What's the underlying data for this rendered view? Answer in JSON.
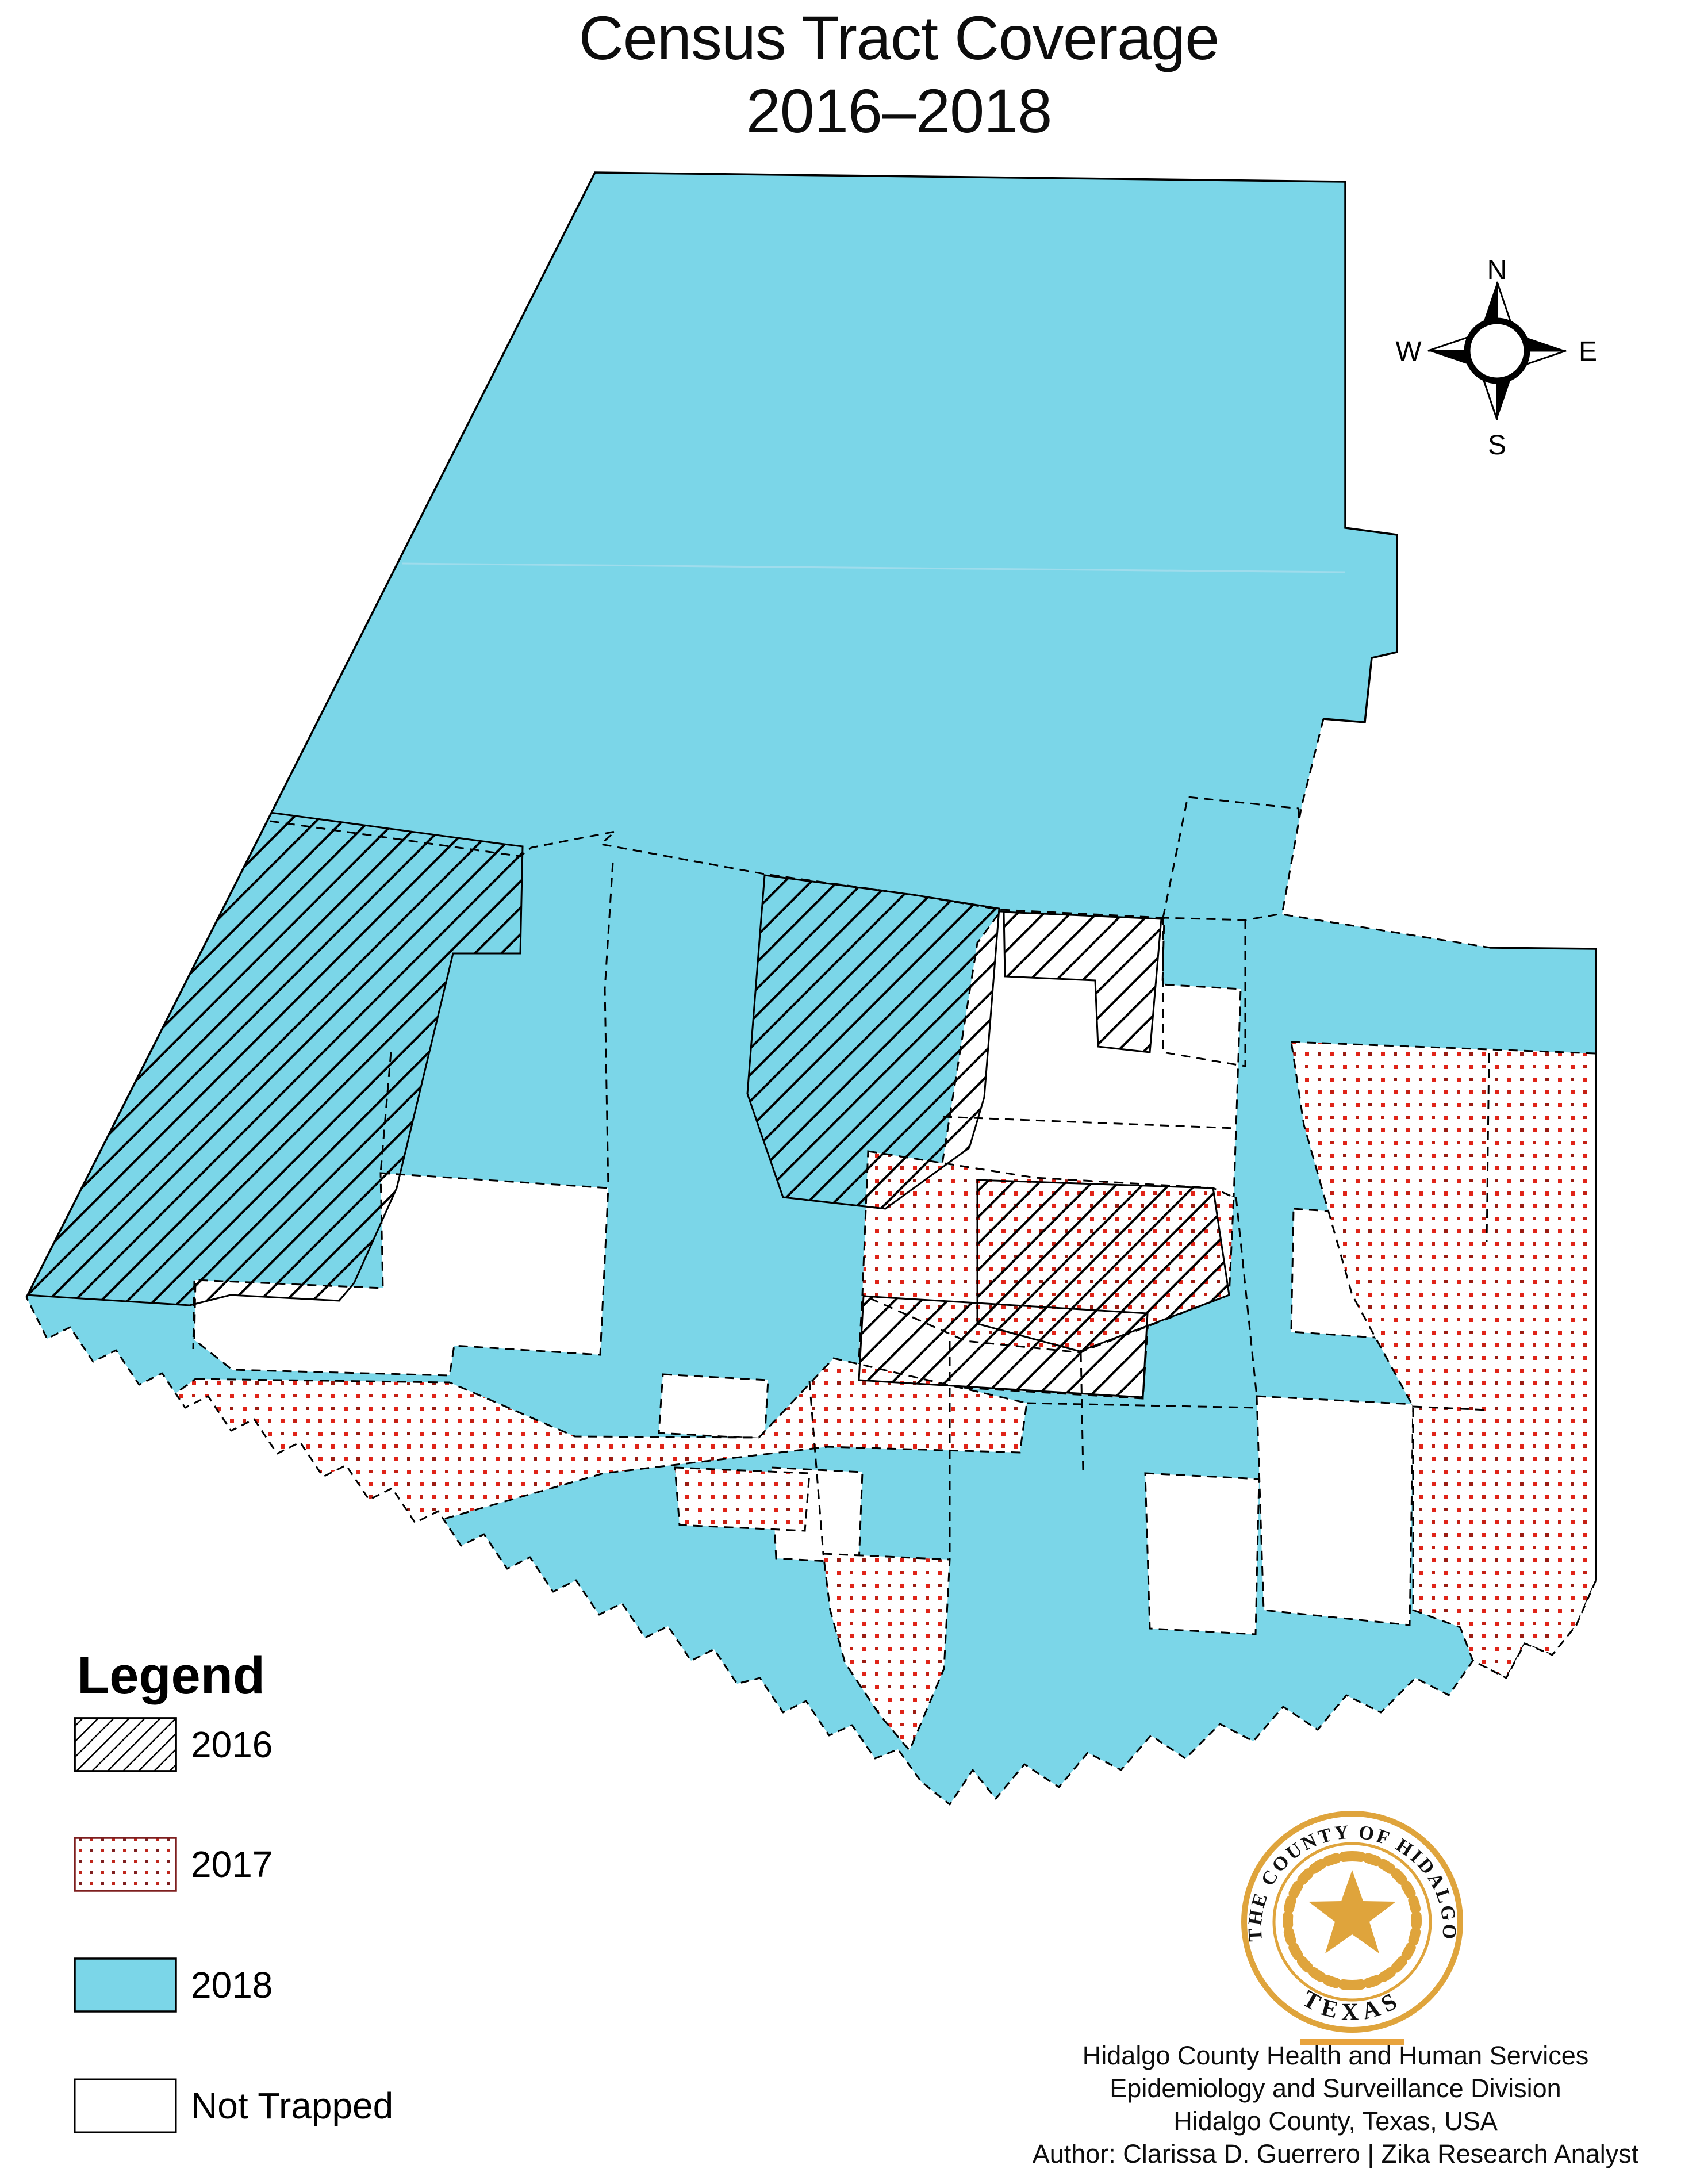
{
  "title": {
    "line1": "Census Tract Coverage",
    "line2": "2016–2018"
  },
  "compass": {
    "north": "N",
    "east": "E",
    "south": "S",
    "west": "W"
  },
  "legend": {
    "heading": "Legend",
    "items": [
      {
        "label": "2016",
        "style": "black-diagonal-hatch",
        "swatch_border": "#000000"
      },
      {
        "label": "2017",
        "style": "red-dot-grid",
        "swatch_border": "#7E1F1F"
      },
      {
        "label": "2018",
        "style": "solid-cyan",
        "swatch_border": "#000000"
      },
      {
        "label": "Not Trapped",
        "style": "white",
        "swatch_border": "#000000"
      }
    ]
  },
  "map": {
    "area": "Hidalgo County, Texas census tracts",
    "colors": {
      "year_2018_fill": "#7BD6E8",
      "dot_red": "#E02418",
      "dot_dark_red": "#9B1C12",
      "hatch_line": "#000000",
      "tract_boundary": "#000000",
      "legend_2017_border": "#7E1F1F",
      "not_trapped_fill": "#FFFFFF"
    }
  },
  "seal": {
    "ring_text": "THE COUNTY OF HIDALGO",
    "bottom_text": "TEXAS",
    "gold": "#DFA43C"
  },
  "attribution": {
    "line1": "Hidalgo County Health and Human Services",
    "line2": "Epidemiology and Surveillance Division",
    "line3": "Hidalgo County, Texas, USA",
    "line4": "Author: Clarissa D. Guerrero | Zika Research Analyst"
  }
}
